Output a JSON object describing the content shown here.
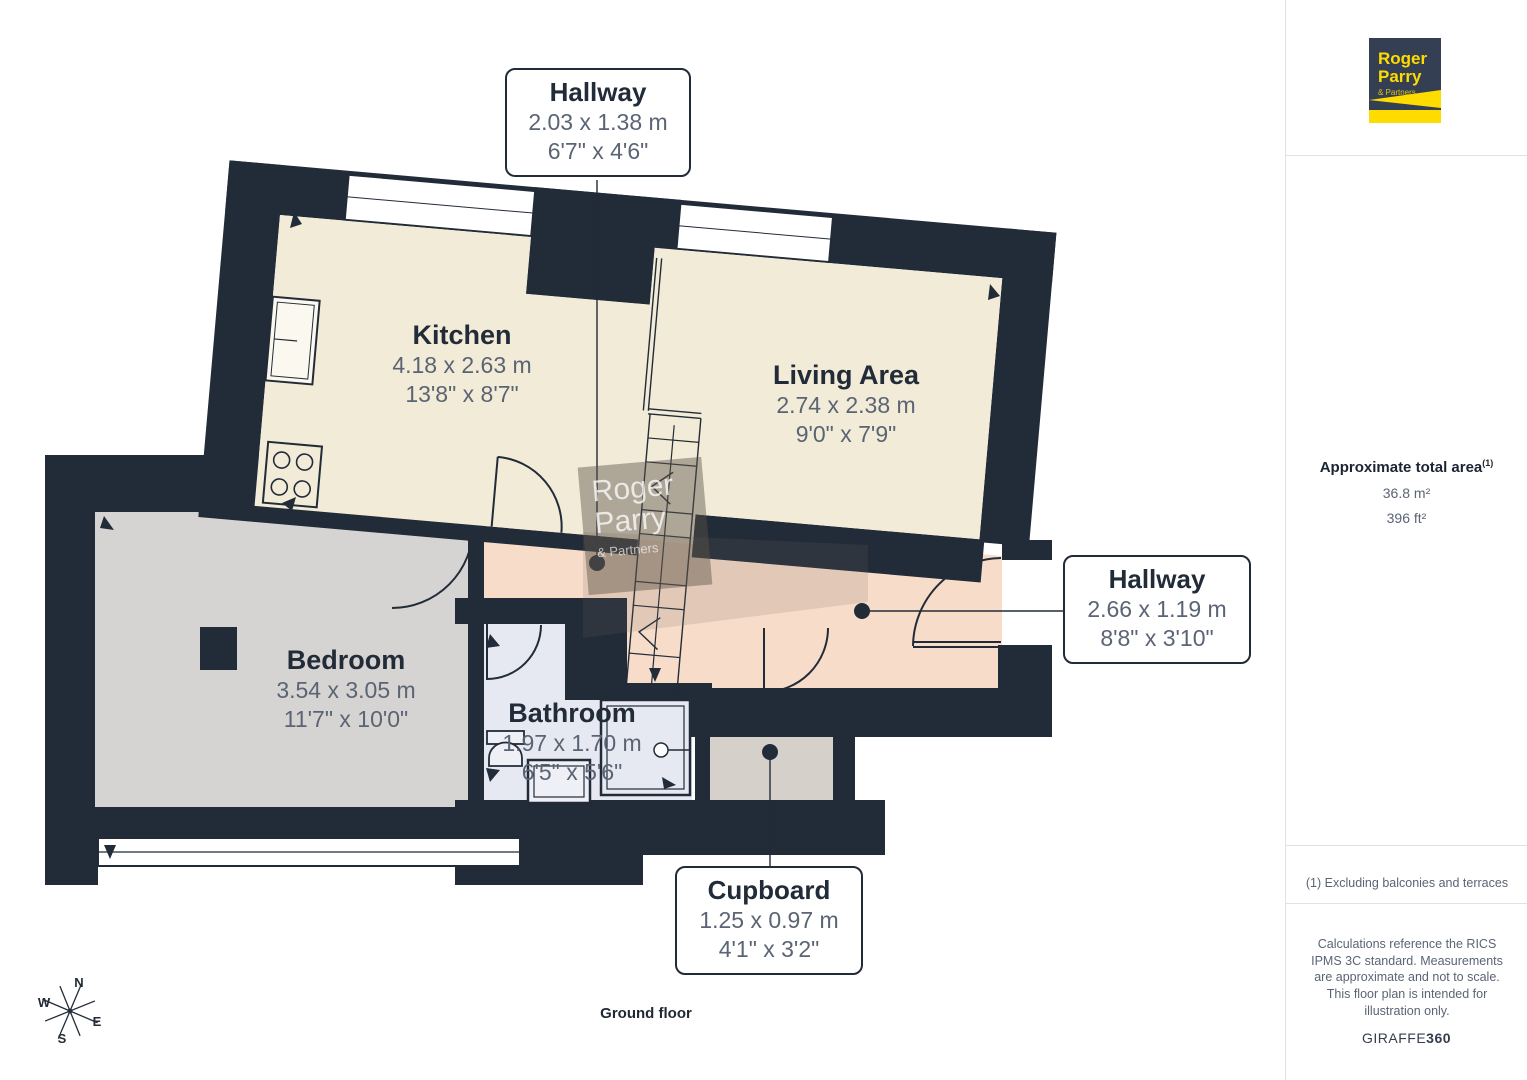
{
  "floor": {
    "label": "Ground floor"
  },
  "rooms": {
    "kitchen": {
      "name": "Kitchen",
      "metric": "4.18 x 2.63 m",
      "imperial": "13'8\" x 8'7\""
    },
    "living": {
      "name": "Living Area",
      "metric": "2.74 x 2.38 m",
      "imperial": "9'0\" x 7'9\""
    },
    "bedroom": {
      "name": "Bedroom",
      "metric": "3.54 x 3.05 m",
      "imperial": "11'7\" x 10'0\""
    },
    "bathroom": {
      "name": "Bathroom",
      "metric": "1.97 x 1.70 m",
      "imperial": "6'5\" x 5'6\""
    }
  },
  "callouts": {
    "hallway_top": {
      "name": "Hallway",
      "metric": "2.03 x 1.38 m",
      "imperial": "6'7\" x 4'6\""
    },
    "hallway_right": {
      "name": "Hallway",
      "metric": "2.66 x 1.19 m",
      "imperial": "8'8\" x 3'10\""
    },
    "cupboard": {
      "name": "Cupboard",
      "metric": "1.25 x 0.97 m",
      "imperial": "4'1\" x 3'2\""
    }
  },
  "compass": {
    "n": "N",
    "e": "E",
    "s": "S",
    "w": "W"
  },
  "watermark": {
    "line1": "Roger",
    "line2": "Parry",
    "line3": "& Partners"
  },
  "logo": {
    "line1": "Roger",
    "line2": "Parry",
    "line3": "& Partners"
  },
  "sidebar": {
    "area_title": "Approximate total area",
    "area_sup": "(1)",
    "area_m2": "36.8 m²",
    "area_ft2": "396 ft²",
    "footnote": "(1) Excluding balconies and terraces",
    "disclaimer": "Calculations reference the RICS IPMS 3C standard. Measurements are approximate and not to scale. This floor plan is intended for illustration only.",
    "brand_name": "GIRAFFE",
    "brand_suffix": "360"
  },
  "colors": {
    "wall": "#222b38",
    "floor_cream": "#f2ebd7",
    "floor_pink": "#f7dcc9",
    "floor_gray": "#d6d4d2",
    "floor_bath": "#e6e9f1",
    "floor_cupboard": "#d5d1ca",
    "dim_text": "#5b6474",
    "title_text": "#222b38",
    "logo_navy": "#353f53",
    "logo_yellow": "#ffdc00"
  }
}
